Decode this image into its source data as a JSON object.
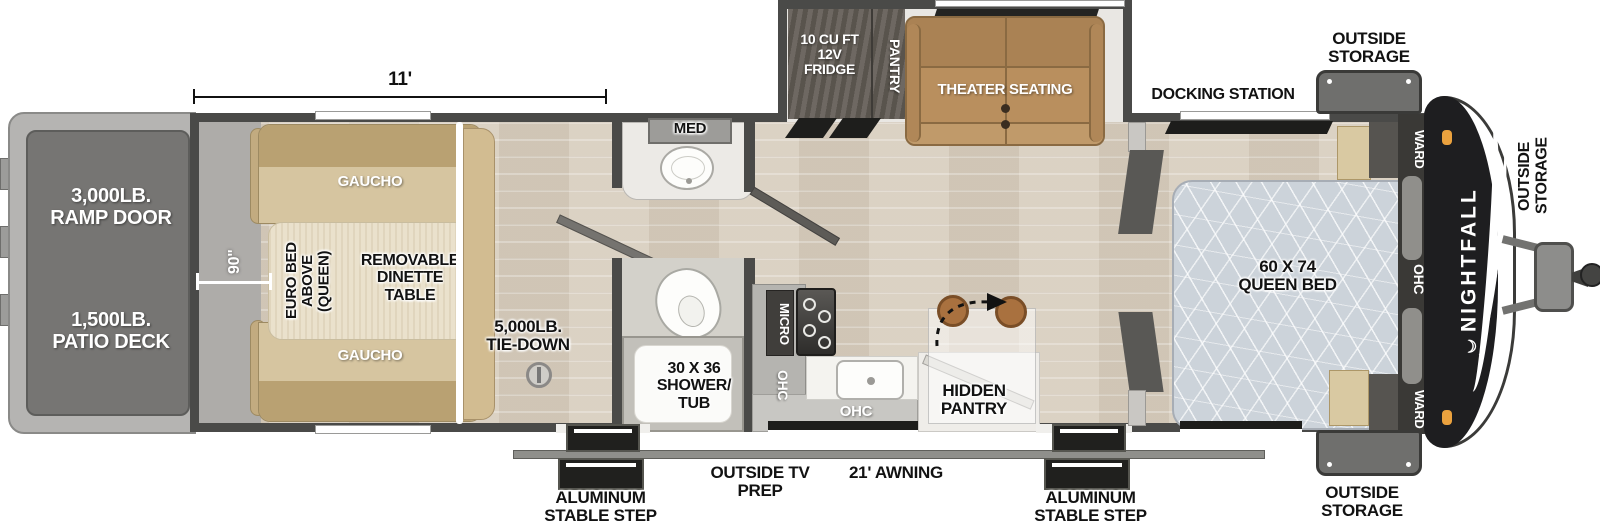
{
  "floorplan": {
    "brand": "NIGHTFALL",
    "crescent_icon": "☾"
  },
  "dimensions": {
    "garage_length": "11'",
    "garage_width": "90\""
  },
  "labels": {
    "ramp_door": "3,000LB.\nRAMP DOOR",
    "patio_deck": "1,500LB.\nPATIO DECK",
    "gaucho": "GAUCHO",
    "euro_bed": "EURO BED\nABOVE\n(QUEEN)",
    "dinette": "REMOVABLE\nDINETTE\nTABLE",
    "tie_down": "5,000LB.\nTIE-DOWN",
    "med": "MED",
    "shower_tub": "30 X 36\nSHOWER/\nTUB",
    "fridge": "10 CU FT\n12V\nFRIDGE",
    "pantry": "PANTRY",
    "theater_seating": "THEATER SEATING",
    "micro": "MICRO",
    "ohc": "OHC",
    "hidden_pantry": "HIDDEN\nPANTRY",
    "docking_station": "DOCKING STATION",
    "queen_bed": "60 X 74\nQUEEN BED",
    "ward": "WARD",
    "outside_storage": "OUTSIDE\nSTORAGE",
    "outside_tv_prep": "OUTSIDE TV\nPREP",
    "awning": "21' AWNING",
    "stable_step": "ALUMINUM\nSTABLE STEP"
  }
}
